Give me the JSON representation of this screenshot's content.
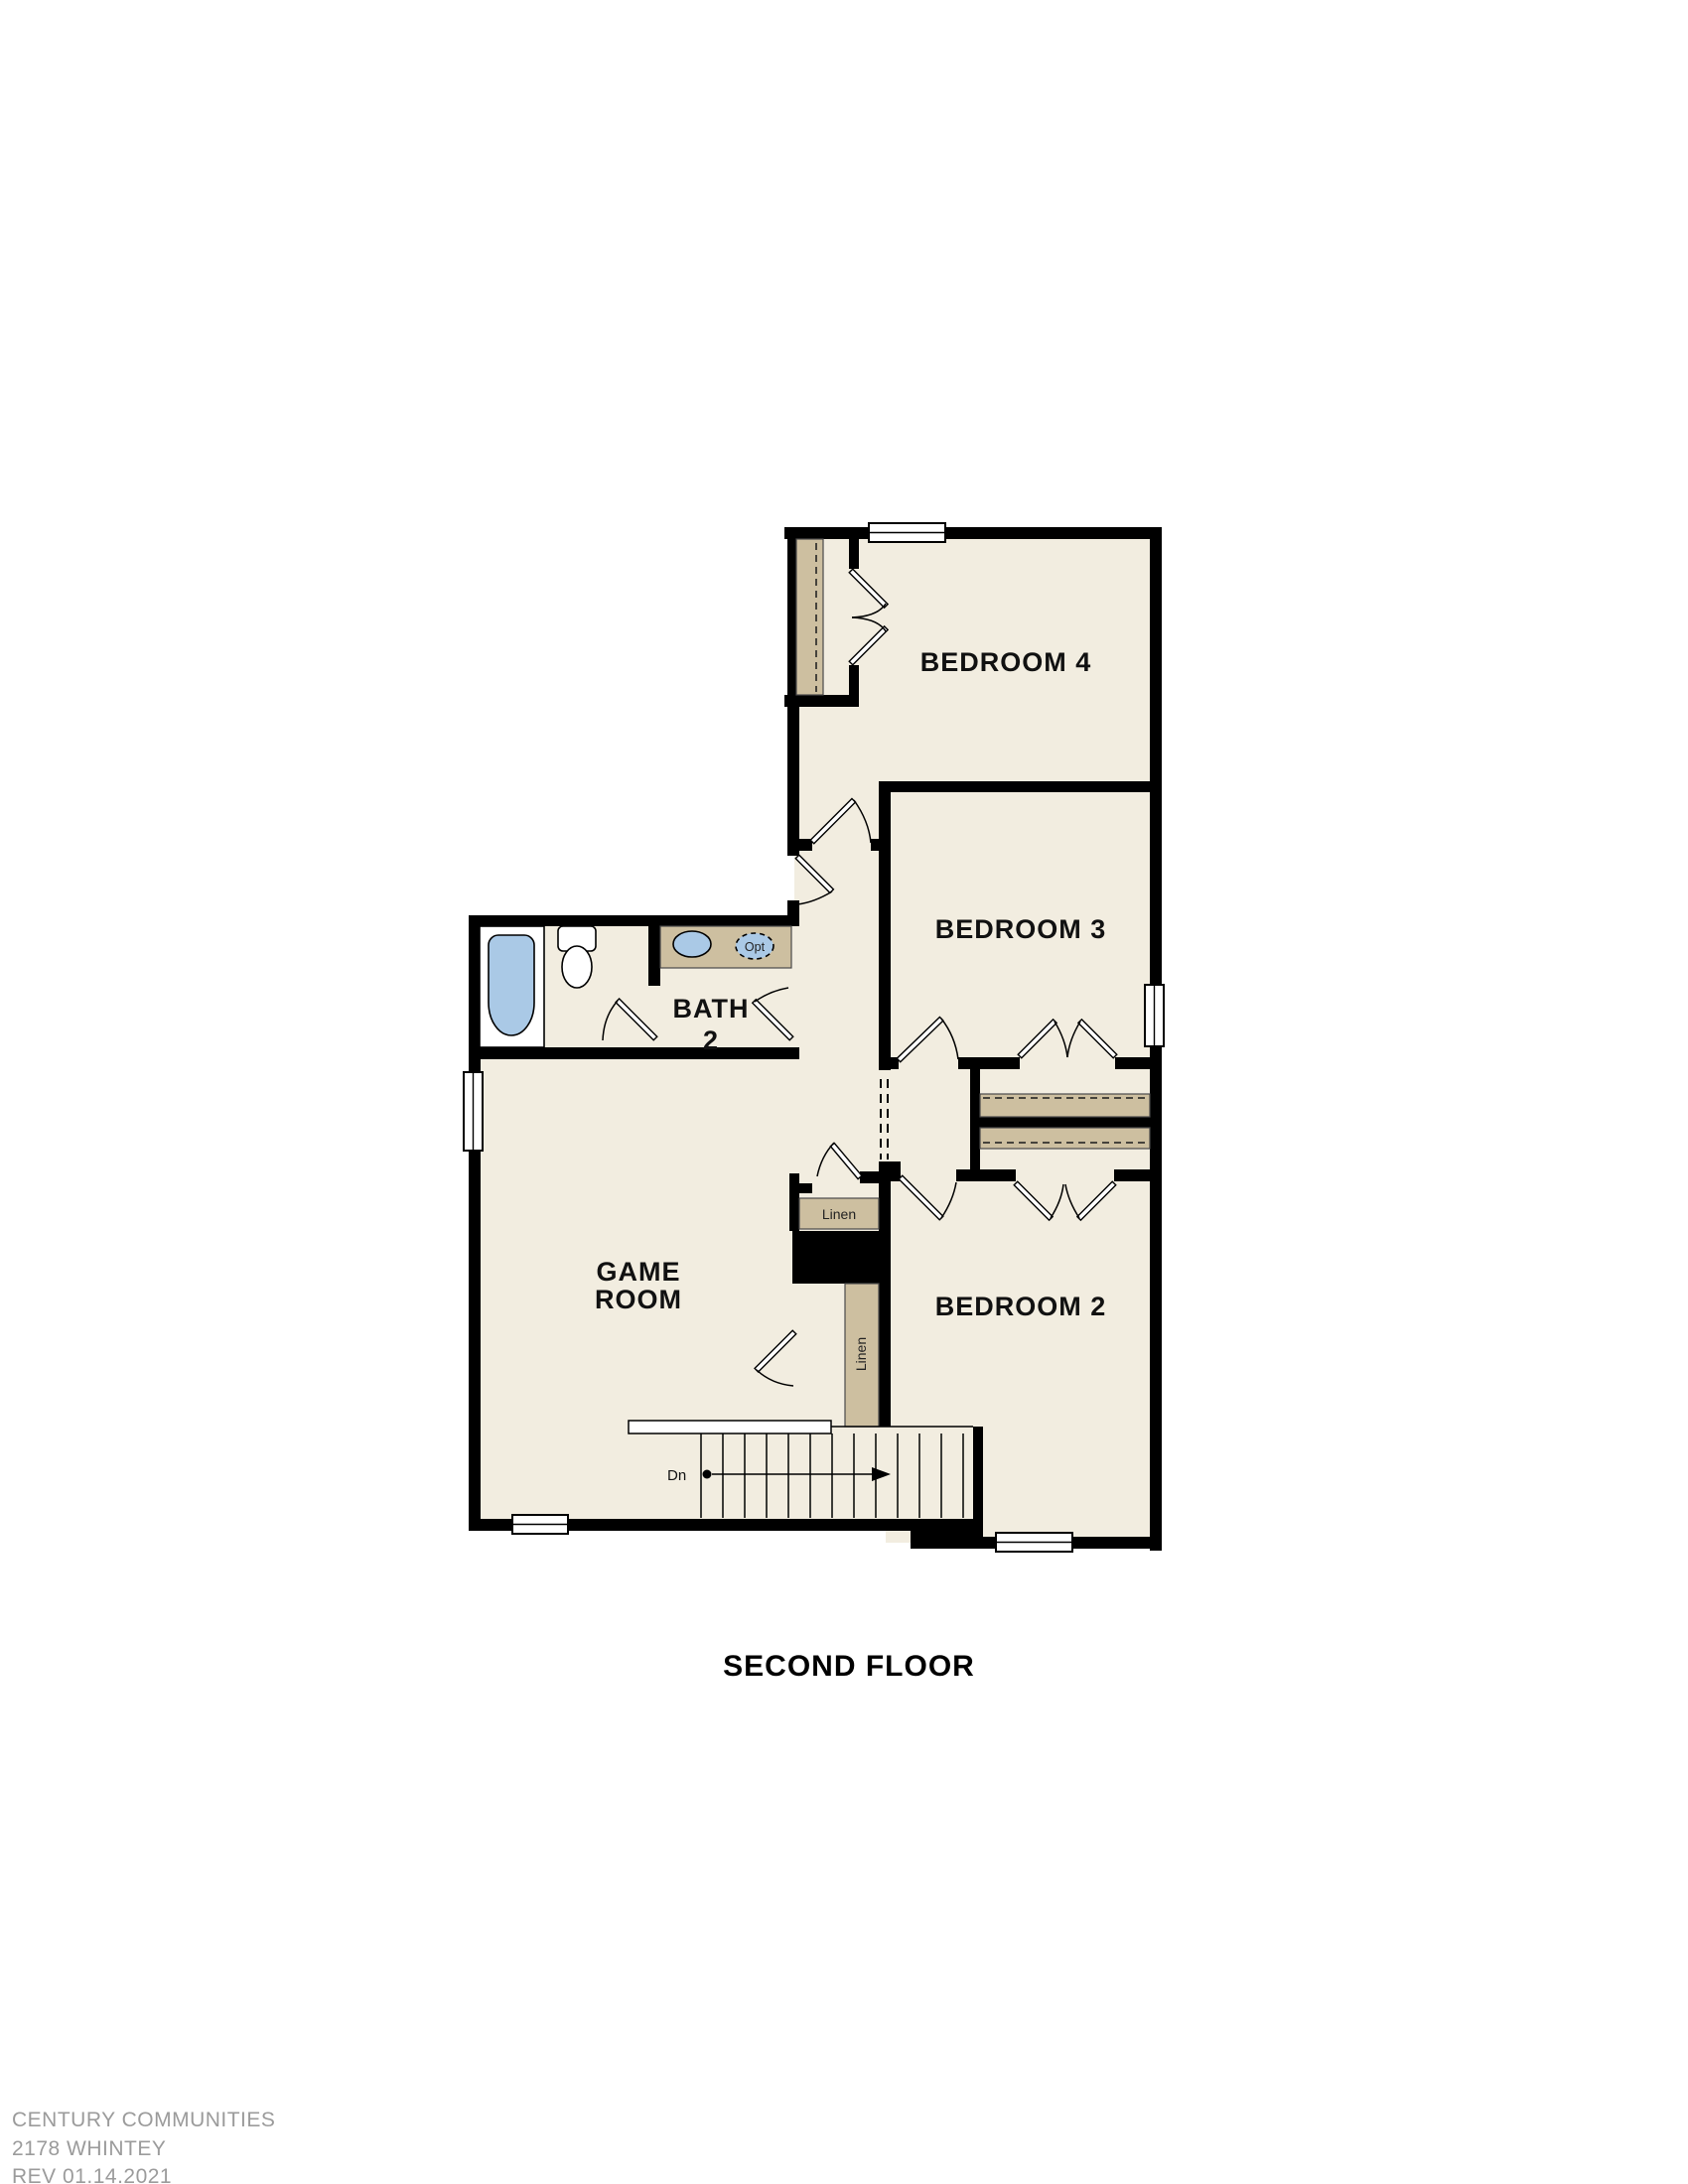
{
  "plan": {
    "title": "SECOND FLOOR",
    "rooms": {
      "bedroom4": "BEDROOM 4",
      "bedroom3": "BEDROOM 3",
      "bedroom2": "BEDROOM 2",
      "bath2_line1": "BATH",
      "bath2_line2": "2",
      "game_line1": "GAME",
      "game_line2": "ROOM"
    },
    "closets": {
      "linen_hall": "Linen",
      "linen_stair": "Linen"
    },
    "stairs": {
      "down_label": "Dn"
    },
    "bath": {
      "optional_sink_label": "Opt"
    }
  },
  "footer": {
    "builder": "CENTURY COMMUNITIES",
    "plan_name": "2178 WHINTEY",
    "revision": "REV 01.14.2021"
  },
  "colors": {
    "wall": "#000000",
    "floor": "#f2ede0",
    "closet_tan": "#cdbfa0",
    "fixture_blue": "#aac9e6",
    "footer_gray": "#9b9b9b"
  }
}
